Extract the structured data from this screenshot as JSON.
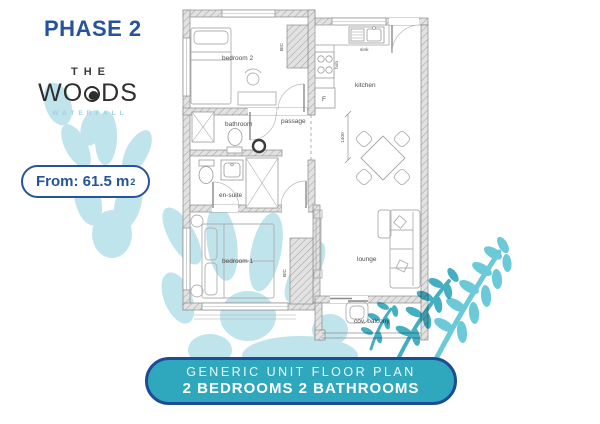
{
  "phase": {
    "label": "PHASE 2"
  },
  "logo": {
    "the": "THE",
    "woods_left": "WO",
    "woods_right": "DS",
    "subtitle": "WATERFALL"
  },
  "badge": {
    "text": "From: 61.5 m",
    "sup": "2"
  },
  "banner": {
    "title": "GENERIC UNIT FLOOR PLAN",
    "subtitle": "2 BEDROOMS 2 BATHROOMS"
  },
  "plan": {
    "rooms": {
      "bedroom2": "bedroom 2",
      "kitchen": "kitchen",
      "bathroom": "bathroom",
      "passage": "passage",
      "ensuite": "en-suite",
      "bedroom1": "bedroom 1",
      "lounge": "lounge",
      "balcony": "cov. balcony"
    },
    "fixtures": {
      "sink": "sink",
      "hob": "hob",
      "fridge": "F",
      "bic": "BIC"
    },
    "dimension": "1400"
  },
  "colors": {
    "primary_blue": "#27539B",
    "banner_teal": "#2FA8BD",
    "light_teal": "#C0E4EB",
    "fern_teal": "#57C2D2",
    "fern_teal_dark": "#2BA4BA"
  }
}
